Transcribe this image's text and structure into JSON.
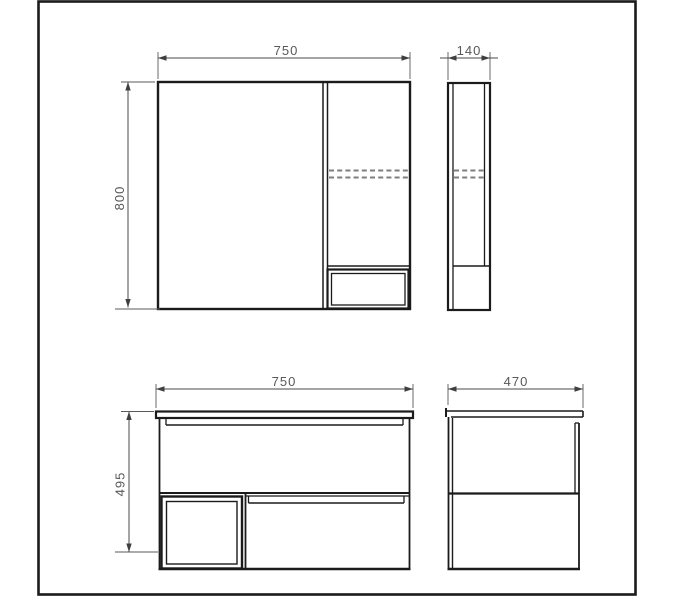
{
  "drawing": {
    "type": "technical-line-drawing",
    "subject": "bathroom furniture set: mirror cabinet and vanity cabinet, four orthographic views with dimensions",
    "views": {
      "mirror_front": {
        "name": "mirror cabinet front view",
        "width": "750",
        "height": "800"
      },
      "mirror_side": {
        "name": "mirror cabinet side view",
        "depth": "140"
      },
      "vanity_front": {
        "name": "vanity cabinet front view",
        "width": "750",
        "height": "495"
      },
      "vanity_side": {
        "name": "vanity cabinet side view",
        "depth": "470"
      }
    },
    "colors": {
      "background": "#ffffff",
      "frame": "#161616",
      "object_lines": "#1b1b1b",
      "dimension_lines": "#4a4a4a",
      "dimension_text": "#585858",
      "hidden_dashed_lines": "#7e7e7e"
    }
  }
}
